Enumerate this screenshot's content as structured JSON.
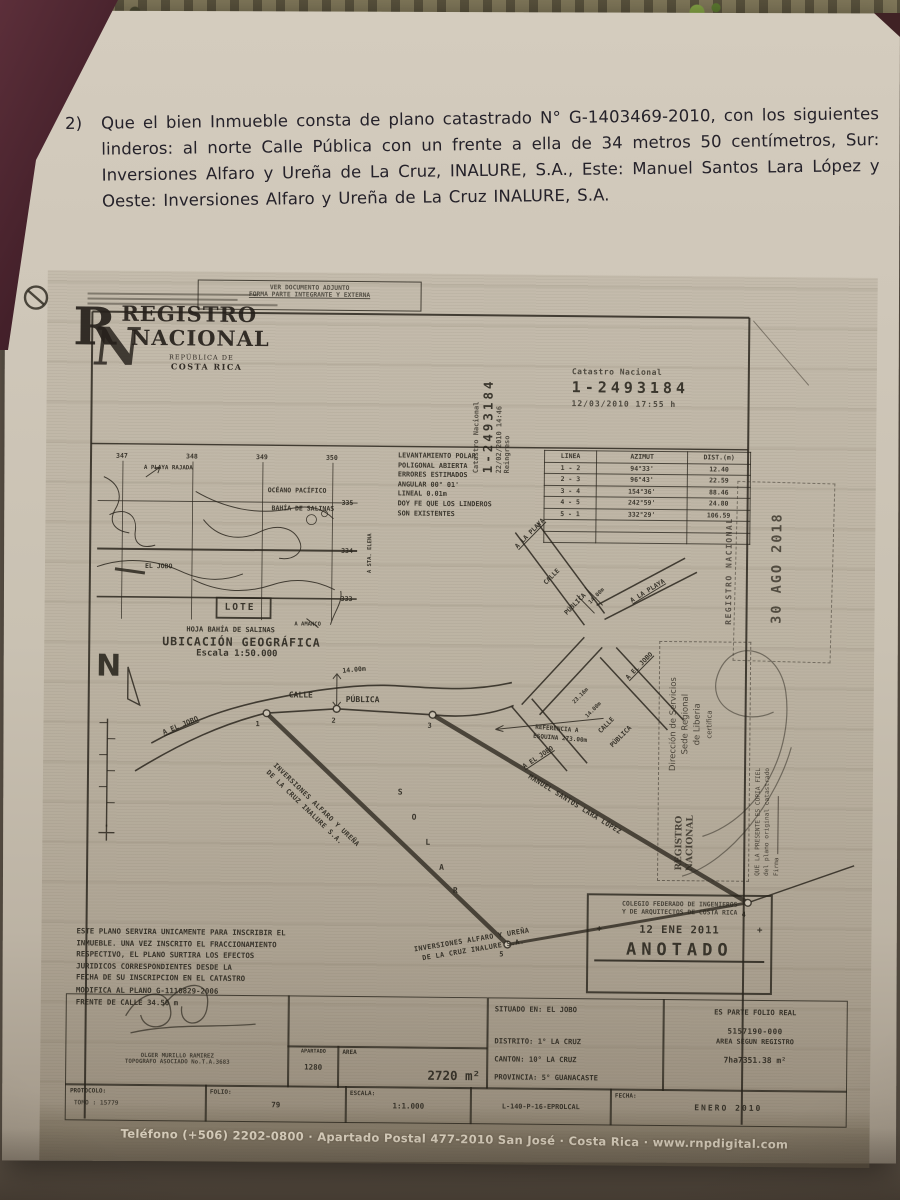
{
  "typed_paragraph": {
    "number": "2)",
    "text": "Que el bien Inmueble consta de plano catastrado N° G-1403469-2010, con los siguientes linderos: al norte Calle Pública con un frente a ella de 34 metros 50 centímetros, Sur: Inversiones Alfaro y Ureña de La Cruz, INALURE, S.A., Este: Manuel Santos Lara López y Oeste: Inversiones Alfaro y Ureña de La Cruz INALURE, S.A."
  },
  "plan": {
    "attach_stamp": {
      "line1": "VER DOCUMENTO ADJUNTO",
      "line2": "FORMA PARTE INTEGRANTE Y EXTERNA"
    },
    "logo": {
      "word1": "REGISTRO",
      "word2": "NACIONAL",
      "sub1": "REPÚBLICA DE",
      "sub2": "COSTA RICA"
    },
    "catastro_vertical": {
      "label": "Catastro Nacional",
      "number": "1-2493184",
      "datetime": "22/02/2010 14:46",
      "note": "Reingreso"
    },
    "catastro_stamp": {
      "label": "Catastro Nacional",
      "number": "1-2493184",
      "datetime": "12/03/2010 17:55 h"
    },
    "survey_notes": [
      "LEVANTAMIENTO POLAR",
      "POLIGONAL ABIERTA",
      "ERRORES ESTIMADOS",
      "ANGULAR 00° 01'",
      "LINEAL 0.01m",
      "DOY FE QUE LOS LINDEROS",
      "SON EXISTENTES"
    ],
    "survey_table": {
      "headers": [
        "LINEA",
        "AZIMUT",
        "DIST.(m)"
      ],
      "rows": [
        [
          "1 - 2",
          "94°33'",
          "12.40"
        ],
        [
          "2 - 3",
          "96°43'",
          "22.59"
        ],
        [
          "3 - 4",
          "154°36'",
          "88.46"
        ],
        [
          "4 - 5",
          "242°59'",
          "24.80"
        ],
        [
          "5 - 1",
          "332°29'",
          "106.59"
        ],
        [
          "",
          "",
          ""
        ],
        [
          "",
          "",
          ""
        ]
      ]
    },
    "location_map": {
      "grid_top": [
        "347",
        "348",
        "349",
        "350"
      ],
      "grid_right": [
        "335",
        "334",
        "333"
      ],
      "labels": {
        "playa_rajada": "A PLAYA RAJADA",
        "oceano": "OCÉANO PACÍFICO",
        "bahia": "BAHÍA DE SALINAS",
        "el_jobo": "EL JOBO",
        "lote": "LOTE",
        "amanco": "A AMANCO",
        "sta_elena": "A STA. ELENA"
      },
      "sheet": "HOJA BAHÍA DE SALINAS",
      "title": "UBICACIÓN GEOGRÁFICA",
      "scale": "Escala 1:50.000"
    },
    "drawing": {
      "north": "N",
      "calle": "CALLE",
      "publica": "PÚBLICA",
      "road_width": "14.00m",
      "a_el_jobo_left": "A EL JOBO",
      "reference1": "REFERENCIA A",
      "reference2": "ESQUINA 273.00m",
      "junction": {
        "a_la_playa_nw": "A LA PLAYA",
        "a_la_playa_ne": "A LA PLAYA",
        "calle": "CALLE",
        "publica": "PÚBLICA",
        "width": "14.00m",
        "a_el_jobo_se": "A EL JOBO"
      },
      "stub": {
        "d1": "23.16m",
        "d2": "14.00m",
        "calle": "CALLE",
        "publica": "PÚBLICA",
        "a_el_jobo": "A EL JOBO"
      },
      "solar_letters": [
        "S",
        "O",
        "L",
        "A",
        "R"
      ],
      "west_boundary_line1": "INVERSIONES ALFARO Y UREÑA",
      "west_boundary_line2": "DE LA CRUZ INALURE S.A.",
      "east_boundary": "MANUEL SANTOS LARA LÓPEZ",
      "south_boundary_line1": "INVERSIONES ALFARO Y UREÑA",
      "south_boundary_line2": "DE LA CRUZ INALURE S.A.",
      "points": [
        "1",
        "2",
        "3",
        "4",
        "5"
      ]
    },
    "legal_notes": [
      "ESTE PLANO SERVIRA UNICAMENTE PARA INSCRIBIR EL",
      "INMUEBLE. UNA VEZ INSCRITO EL FRACCIONAMIENTO",
      "RESPECTIVO, EL PLANO SURTIRA LOS EFECTOS",
      "JURIDICOS CORRESPONDIENTES DESDE LA",
      "FECHA DE SU INSCRIPCION EN EL CATASTRO",
      "MODIFICA AL PLANO G-1110829-2006",
      "FRENTE DE CALLE 34.50 m"
    ],
    "cfia_stamp": {
      "line1": "COLEGIO FEDERADO DE INGENIEROS",
      "line2": "Y DE ARQUITECTOS DE COSTA RICA",
      "date": "12 ENE 2011",
      "side_mark": "+",
      "word": "ANOTADO"
    },
    "date_stamp": "30 AGO 2018",
    "registro_vertical": "REGISTRO NACIONAL",
    "cert_stamp": {
      "logo1": "REGISTRO",
      "logo2": "NACIONAL",
      "line1": "Dirección de Servicios",
      "line2": "Sede Regional",
      "line3": "de Liberia",
      "line4": "certifica",
      "body1": "QUE LA PRESENTE ES COPIA FIEL",
      "body2": "del plano original catastrado",
      "firma": "Firma"
    },
    "info": {
      "situado": "SITUADO EN: EL JOBO",
      "distrito": "DISTRITO: 1° LA CRUZ",
      "canton": "CANTON: 10° LA CRUZ",
      "provincia": "PROVINCIA: 5° GUANACASTE",
      "folio_real_1": "ES PARTE FOLIO REAL",
      "folio_real_2": "5157190-000",
      "folio_real_3": "AREA SEGUN REGISTRO",
      "folio_real_4": "7ha7351.38 m²",
      "apartado_label": "APARTADO",
      "apartado_value": "1280",
      "area_label": "AREA",
      "area_value": "2720 m²",
      "protocolo_label": "PROTOCOLO:",
      "protocolo_value": "TOMO : 15779",
      "folio_label": "FOLIO:",
      "folio_value": "79",
      "escala_label": "ESCALA:",
      "escala_value": "1:1.000",
      "plano_ref": "L-140-P-16-EPROLCAL",
      "fecha_label": "FECHA:",
      "fecha_value": "ENERO 2010",
      "surveyor_name": "OLGER MURILLO RAMIREZ",
      "surveyor_title": "TOPOGRAFO ASOCIADO No.T.A.3683"
    },
    "footer": "Teléfono (+506) 2202-0800 · Apartado Postal 477-2010 San José · Costa Rica · www.rnpdigital.com"
  }
}
